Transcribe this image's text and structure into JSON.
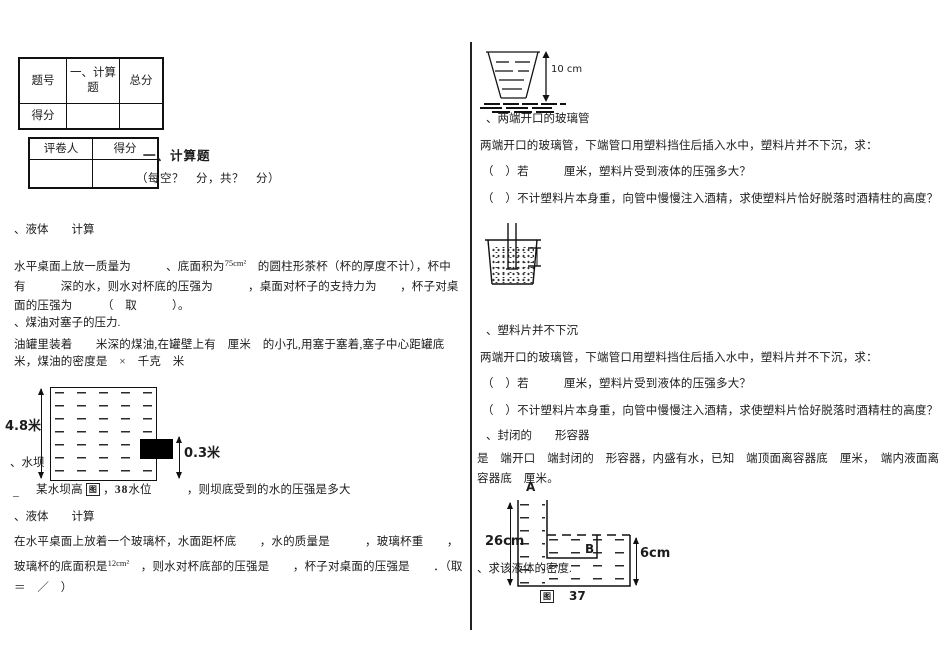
{
  "summary_table": {
    "r1c1": "题号",
    "r1c2": "一、计算题",
    "r1c3": "总分",
    "r2c1": "得分",
    "r2c2": "",
    "r2c3": ""
  },
  "grader_table": {
    "h1": "评卷人",
    "h2": "得分",
    "r2c1": "",
    "r2c2": ""
  },
  "section": {
    "title": "一、计算题",
    "note": "（每空？　分，共？　分）"
  },
  "left": {
    "q1_label": "、液体　　计算",
    "q1": {
      "pre": "水平桌面上放一质量为　　　、底面积为",
      "sup": "75cm²",
      "post": "　的圆柱形茶杯（杯的厚度不计），杯中有　　　深的水，则水对杯底的压强为　　　，桌面对杯子的支持力为　　，杯子对桌面的压强为　　　（　取　　　）。"
    },
    "q2_label": "、煤油对塞子的压力.",
    "q2": "油罐里装着　　米深的煤油,在罐壁上有　厘米　的小孔,用塞于塞着,塞子中心距罐底　　米，煤油的密度是　×　千克　米",
    "tank": {
      "height_label": "4.8米",
      "plug_label": "0.3米"
    },
    "q3_label": "、水坝",
    "q3": {
      "pre": "某水坝高 ",
      "img": "图",
      "mid": " ，",
      "num": "38",
      "post": "水位　　　，则坝底受到的水的压强是多大"
    },
    "underscore": "_",
    "q4_label": "、液体　　计算",
    "q4": {
      "pre": "在水平桌面上放着一个玻璃杯，水面距杯底　　，水的质量是　　　，玻璃杯重　　，玻璃杯的底面积是",
      "sup": "12cm²",
      "post": "　，则水对杯底部的压强是　　，杯子对桌面的压强是　　．（取　＝　／　）"
    }
  },
  "right": {
    "cup_label": "10 cm",
    "q5_label": "、两端开口的玻璃管",
    "q5_intro": "两端开口的玻璃管，下端管口用塑料挡住后插入水中，塑料片并不下沉，求：",
    "q5_a": "（　）若　　　厘米，塑料片受到液体的压强多大？",
    "q5_b": "（　）不计塑料片本身重，向管中慢慢注入酒精，求使塑料片恰好脱落时酒精柱的高度？",
    "q6_label": "、塑料片并不下沉",
    "q6_intro": "两端开口的玻璃管，下端管口用塑料挡住后插入水中，塑料片并不下沉，求：",
    "q6_a": "（　）若　　　厘米，塑料片受到液体的压强多大？",
    "q6_b": "（　）不计塑料片本身重，向管中慢慢注入酒精，求使塑料片恰好脱落时酒精柱的高度？",
    "q7_label": "、封闭的　　形容器",
    "q7": "是　端开口　端封闭的　形容器，内盛有水，已知　端顶面离容器底　厘米，　端内液面离容器底　厘米。",
    "lshape": {
      "label_a": "A",
      "label_b": "B",
      "left_dim": "26cm",
      "right_dim": "6cm",
      "fig_box": "图",
      "fig_num": "37"
    },
    "q8_label": "、求该液体的密度."
  }
}
